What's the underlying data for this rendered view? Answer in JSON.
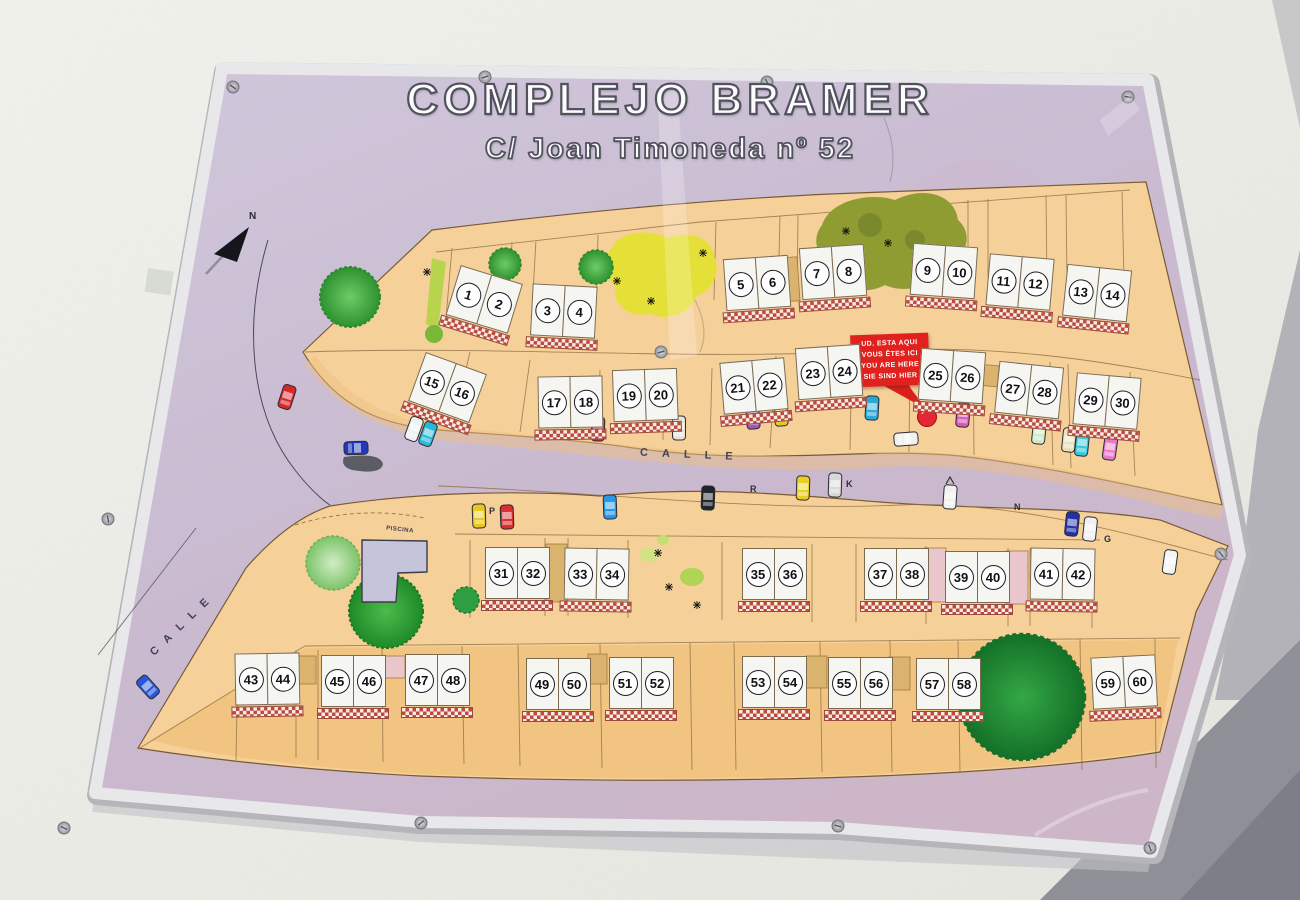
{
  "sign": {
    "title": "COMPLEJO BRAMER",
    "subtitle": "C/ Joan Timoneda nº 52"
  },
  "map": {
    "you_are_here_sign": {
      "line1": "UD. ESTA AQUI",
      "line2": "VOUS ÊTES ICI",
      "line3": "YOU ARE HERE",
      "line4": "SIE SIND HIER"
    },
    "street_label_main": "CALLE",
    "street_label_left": "CALLE",
    "pool_label": "PISCINA",
    "north_label": "N",
    "parking_letters": {
      "p": "P",
      "r": "R",
      "k": "K",
      "n": "N",
      "g": "G"
    },
    "unit_pairs": [
      {
        "a": "1",
        "b": "2"
      },
      {
        "a": "3",
        "b": "4"
      },
      {
        "a": "5",
        "b": "6"
      },
      {
        "a": "7",
        "b": "8"
      },
      {
        "a": "9",
        "b": "10"
      },
      {
        "a": "11",
        "b": "12"
      },
      {
        "a": "13",
        "b": "14"
      },
      {
        "a": "15",
        "b": "16"
      },
      {
        "a": "17",
        "b": "18"
      },
      {
        "a": "19",
        "b": "20"
      },
      {
        "a": "21",
        "b": "22"
      },
      {
        "a": "23",
        "b": "24"
      },
      {
        "a": "25",
        "b": "26"
      },
      {
        "a": "27",
        "b": "28"
      },
      {
        "a": "29",
        "b": "30"
      },
      {
        "a": "31",
        "b": "32"
      },
      {
        "a": "33",
        "b": "34"
      },
      {
        "a": "35",
        "b": "36"
      },
      {
        "a": "37",
        "b": "38"
      },
      {
        "a": "39",
        "b": "40"
      },
      {
        "a": "41",
        "b": "42"
      },
      {
        "a": "43",
        "b": "44"
      },
      {
        "a": "45",
        "b": "46"
      },
      {
        "a": "47",
        "b": "48"
      },
      {
        "a": "49",
        "b": "50"
      },
      {
        "a": "51",
        "b": "52"
      },
      {
        "a": "53",
        "b": "54"
      },
      {
        "a": "55",
        "b": "56"
      },
      {
        "a": "57",
        "b": "58"
      },
      {
        "a": "59",
        "b": "60"
      }
    ],
    "colors": {
      "panel_lilac": "#c9bad0",
      "block_orange": "#f5d099",
      "checker_red": "#bd4a40",
      "you_are_here_red": "#e0211d",
      "tree_green": "#3aa83a",
      "yellow_patch": "#e4e032"
    }
  }
}
